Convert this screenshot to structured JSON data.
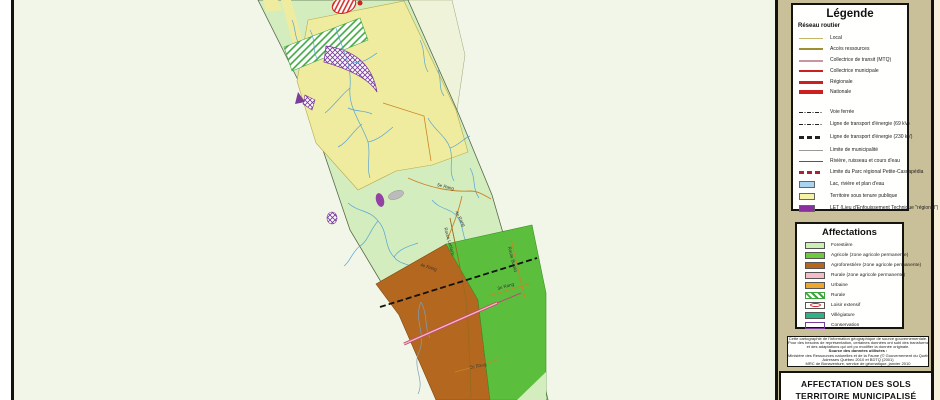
{
  "legend": {
    "title": "Légende",
    "road_network": {
      "title": "Réseau routier",
      "items": [
        {
          "label": "Local",
          "color": "#c8b464"
        },
        {
          "label": "Accès ressources",
          "color": "#9e8f30"
        },
        {
          "label": "Collectrice de transit (MTQ)",
          "color": "#c995a5"
        },
        {
          "label": "Collectrice municipale",
          "color": "#cc2020"
        },
        {
          "label": "Régionale",
          "color": "#cc2020"
        },
        {
          "label": "Nationale",
          "color": "#cc2020"
        }
      ]
    },
    "other_items": [
      {
        "label": "Voie ferrée",
        "style": "dash-dot-black"
      },
      {
        "label": "Ligne de transport d'énergie (69 kV)",
        "style": "dash-dot-black-thin"
      },
      {
        "label": "Ligne de transport d'énergie (230 kV)",
        "style": "thick-black-dash"
      },
      {
        "label": "Limite de municipalité",
        "color": "#999999"
      },
      {
        "label": "Rivière, ruisseau et cours d'eau",
        "color": "#3d5a98"
      },
      {
        "label": "Limite du Parc régional Petite-Cascapédia",
        "color": "#b02030"
      },
      {
        "label": "Lac, rivière et plan d'eau",
        "color": "#a9d3ee"
      },
      {
        "label": "Territoire sous tenure publique",
        "color": "#f6f3a9"
      },
      {
        "label": "LET (Lieu d'Enfouissement Technique \"régional\")",
        "color": "#8a2f9e"
      }
    ],
    "affectations": {
      "title": "Affectations",
      "items": [
        {
          "label": "Forestière",
          "color": "#ccf0b4"
        },
        {
          "label": "Agricole (zone agricole permanente)",
          "color": "#6fca3b"
        },
        {
          "label": "Agroforestière (zone agricole permanente)",
          "color": "#b4671e"
        },
        {
          "label": "Rurale (zone agricole permanente)",
          "color": "#f5bcc8"
        },
        {
          "label": "Urbaine",
          "color": "#eda72e"
        },
        {
          "label": "Rurale",
          "color": "#3da53d",
          "pattern": "green-hatch"
        },
        {
          "label": "Loisir extensif",
          "color": "#d42020",
          "pattern": "red-outline"
        },
        {
          "label": "Villégiature",
          "color": "#2fb284"
        },
        {
          "label": "Conservation",
          "color": "#7a3d99",
          "pattern": "purple-crosshatch"
        }
      ]
    }
  },
  "notes": {
    "lines": [
      "Cette cartographie de l'information géographique de source gouvernementale.",
      "Pour des besoins de représentation, certaines données ont subi des transformations",
      "et des adaptations qui ont pu modifier la donnée originale.",
      "Source des données utilisées :",
      "Ministère des Ressources naturelles et de la Faune (© Gouvernement du Québec)",
      "Adresses Québec 2010 et BDTQ (2001)",
      "MRC de Bonaventure, service de géomatique, janvier 2010"
    ]
  },
  "title_block": {
    "line1": "AFFECTATION DES SOLS",
    "line2": "TERRITOIRE MUNICIPALISÉ"
  },
  "map": {
    "labels": [
      {
        "text": "5e Rang"
      },
      {
        "text": "4e Rang"
      },
      {
        "text": "4e Rang"
      },
      {
        "text": "3e Rang"
      },
      {
        "text": "2e Rang"
      },
      {
        "text": "Route Leblanc"
      },
      {
        "text": "Route Bujold"
      }
    ]
  },
  "colors": {
    "sheet": "#f2f6e8",
    "panel": "#c9bf98",
    "forest_green": "#d4edbe",
    "public_yellow": "#efec9f",
    "agricole_green": "#5bbf3d",
    "agroforest_brown": "#b4671e",
    "river_blue": "#58a5d5",
    "road_orange": "#c98527",
    "pink_road": "#e798ab"
  }
}
